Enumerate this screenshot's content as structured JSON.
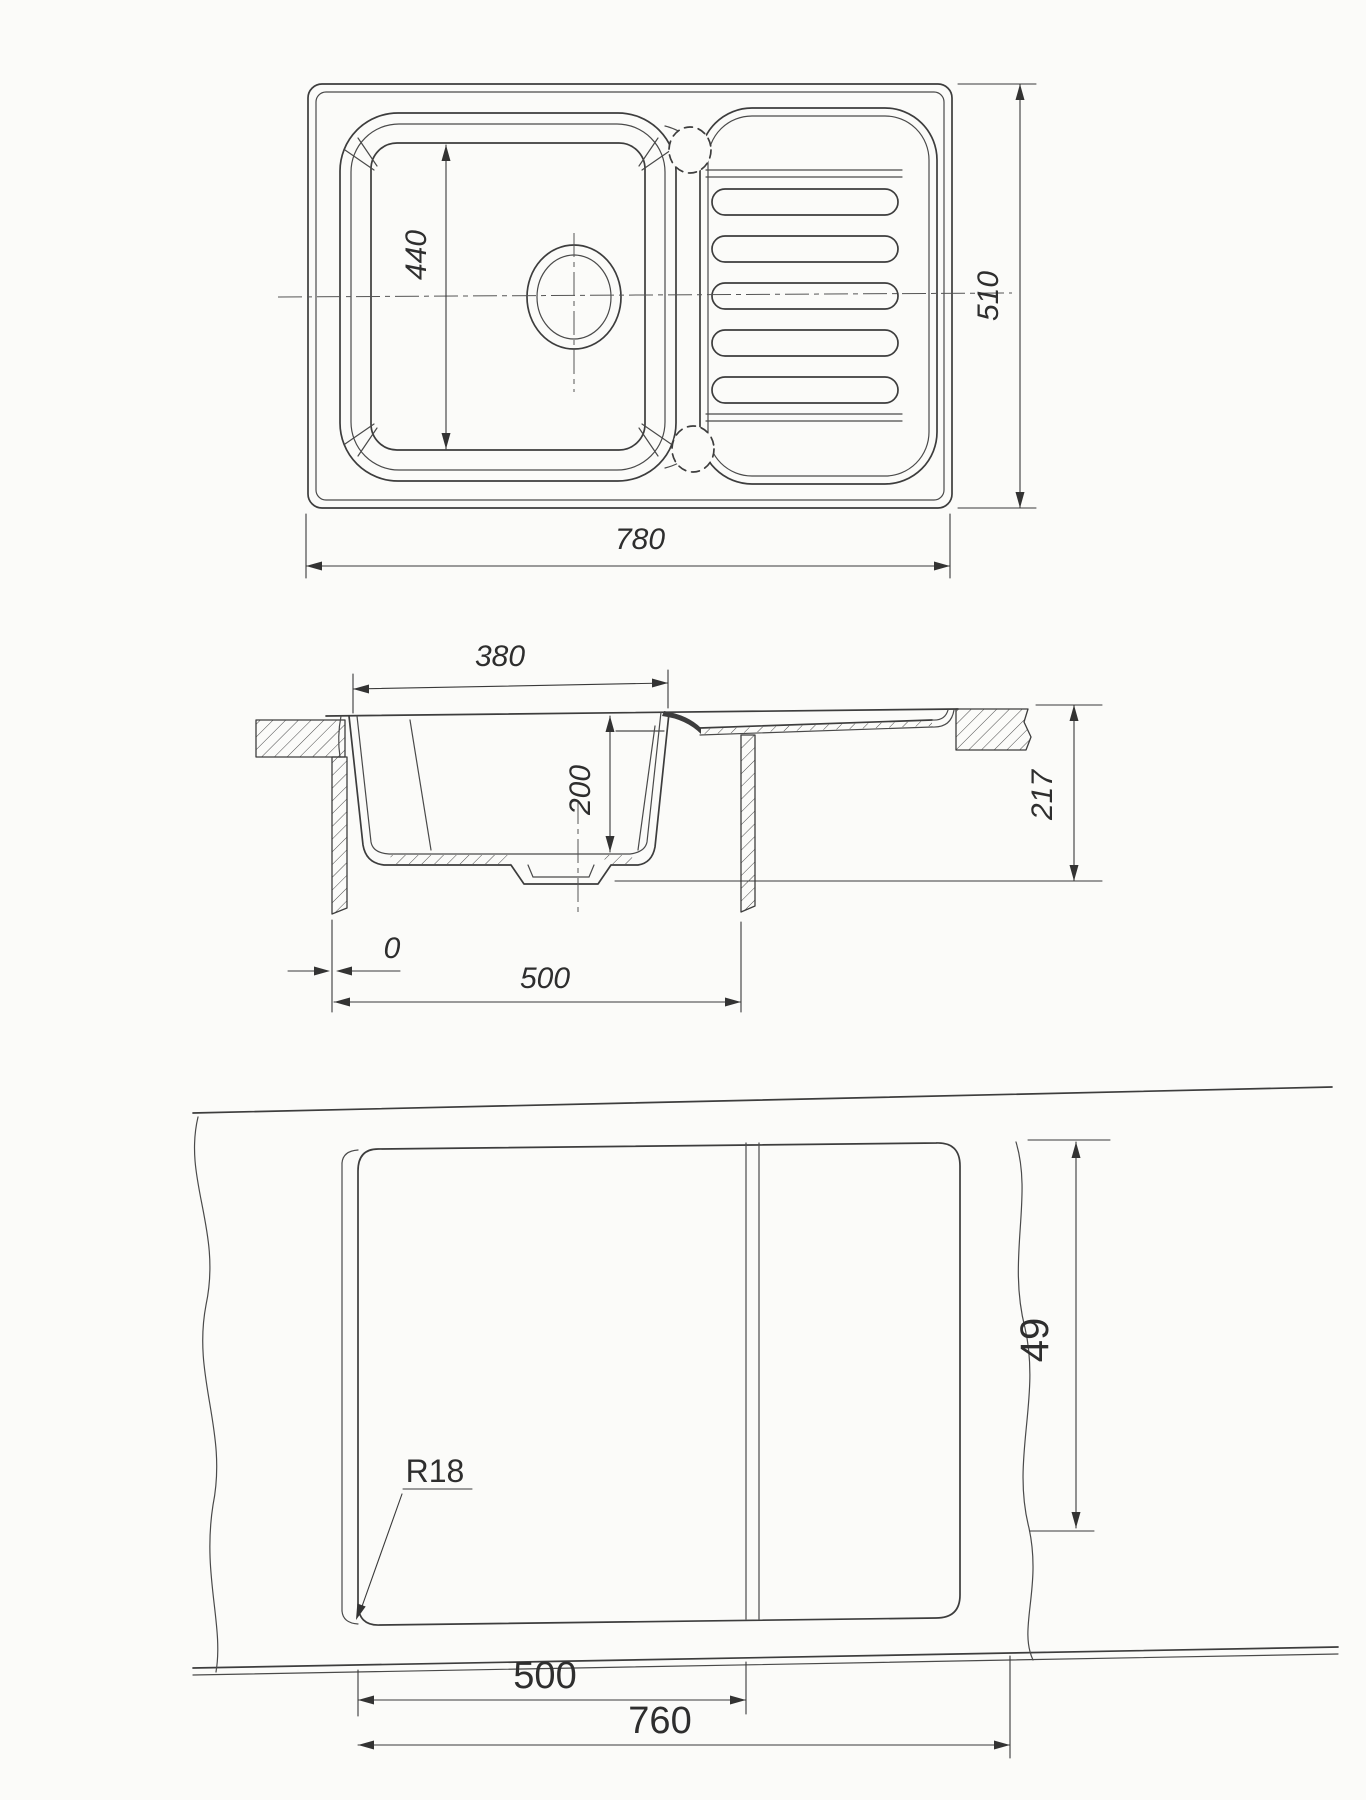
{
  "drawing": {
    "subject": "kitchen sink with drainboard - dimensioned technical drawing",
    "colors": {
      "line": "#3d3d3d",
      "paper": "#fbfbf9"
    },
    "views": {
      "plan": {
        "dims": {
          "bowl_inner_length": "440",
          "overall_width": "780",
          "overall_depth": "510"
        }
      },
      "section": {
        "dims": {
          "bowl_top_width": "380",
          "bowl_depth": "200",
          "overall_height": "217",
          "edge_offset": "0",
          "cabinet_width": "500"
        }
      },
      "cutout": {
        "dims": {
          "corner_radius": "R18",
          "bowl_cutout_width": "500",
          "cutout_width": "760",
          "cutout_depth": "49"
        }
      }
    }
  }
}
